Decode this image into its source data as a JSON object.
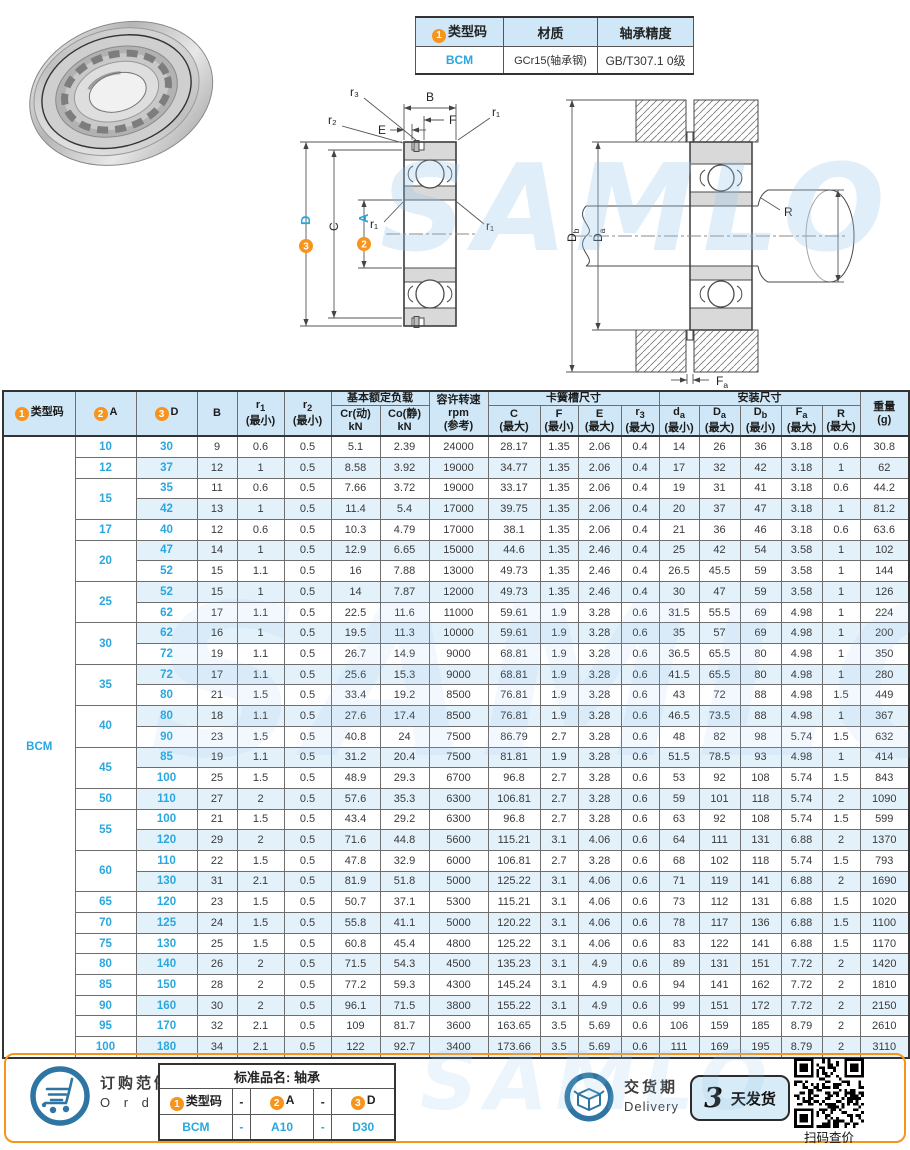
{
  "top_table": {
    "headers": {
      "type": {
        "badge": "1",
        "label": "类型码"
      },
      "material": "材质",
      "precision": "轴承精度"
    },
    "row": {
      "type_code": "BCM",
      "material": "GCr15(轴承钢)",
      "precision": "GB/T307.1 0级"
    }
  },
  "diagram": {
    "front": {
      "b": "B",
      "f": "F",
      "e": "E",
      "r3": "r₃",
      "r2": "r₂",
      "r1_tr": "r₁",
      "r1_ml": "r₁",
      "r1_mr": "r₁",
      "c": "C",
      "a": {
        "badge": "2",
        "letter": "A"
      },
      "d": {
        "badge": "3",
        "letter": "D"
      }
    },
    "mount": {
      "db": {
        "m": "D",
        "s": "b"
      },
      "da_housing": {
        "m": "D",
        "s": "a"
      },
      "da_shaft": {
        "m": "d",
        "s": "a"
      },
      "r": "R",
      "fa": {
        "m": "F",
        "s": "a"
      }
    }
  },
  "main_table": {
    "type_code": "BCM",
    "headers": {
      "type": {
        "badge": "1",
        "label": "类型码"
      },
      "a": {
        "badge": "2",
        "label": "A"
      },
      "d": {
        "badge": "3",
        "label": "D"
      },
      "b": "B",
      "r1": {
        "m": "r",
        "s": "1",
        "note": "(最小)"
      },
      "r2": {
        "m": "r",
        "s": "2",
        "note": "(最小)"
      },
      "load_group": "基本额定负载",
      "cr": {
        "l1": "Cr(动)",
        "l2": "kN"
      },
      "co": {
        "l1": "Co(静)",
        "l2": "kN"
      },
      "rpm": {
        "l1": "容许转速",
        "l2": "rpm",
        "l3": "(参考)"
      },
      "snap_group": "卡簧槽尺寸",
      "c": {
        "m": "C",
        "s": "",
        "note": "(最大)"
      },
      "f": {
        "m": "F",
        "s": "",
        "note": "(最小)"
      },
      "e": {
        "m": "E",
        "s": "",
        "note": "(最大)"
      },
      "r3": {
        "m": "r",
        "s": "3",
        "note": "(最大)"
      },
      "mount_group": "安装尺寸",
      "da": {
        "m": "d",
        "s": "a",
        "note": "(最小)"
      },
      "Da": {
        "m": "D",
        "s": "a",
        "note": "(最大)"
      },
      "Db": {
        "m": "D",
        "s": "b",
        "note": "(最小)"
      },
      "Fa": {
        "m": "F",
        "s": "a",
        "note": "(最大)"
      },
      "R": {
        "m": "R",
        "s": "",
        "note": "(最大)"
      },
      "weight": {
        "l1": "重量",
        "l2": "(g)"
      }
    },
    "groups": [
      {
        "a": "10",
        "rows": [
          {
            "d": "30",
            "v": [
              "9",
              "0.6",
              "0.5",
              "5.1",
              "2.39",
              "24000",
              "28.17",
              "1.35",
              "2.06",
              "0.4",
              "14",
              "26",
              "36",
              "3.18",
              "0.6",
              "30.8"
            ]
          }
        ]
      },
      {
        "a": "12",
        "rows": [
          {
            "d": "37",
            "v": [
              "12",
              "1",
              "0.5",
              "8.58",
              "3.92",
              "19000",
              "34.77",
              "1.35",
              "2.06",
              "0.4",
              "17",
              "32",
              "42",
              "3.18",
              "1",
              "62"
            ]
          }
        ]
      },
      {
        "a": "15",
        "rows": [
          {
            "d": "35",
            "v": [
              "11",
              "0.6",
              "0.5",
              "7.66",
              "3.72",
              "19000",
              "33.17",
              "1.35",
              "2.06",
              "0.4",
              "19",
              "31",
              "41",
              "3.18",
              "0.6",
              "44.2"
            ]
          },
          {
            "d": "42",
            "v": [
              "13",
              "1",
              "0.5",
              "11.4",
              "5.4",
              "17000",
              "39.75",
              "1.35",
              "2.06",
              "0.4",
              "20",
              "37",
              "47",
              "3.18",
              "1",
              "81.2"
            ]
          }
        ]
      },
      {
        "a": "17",
        "rows": [
          {
            "d": "40",
            "v": [
              "12",
              "0.6",
              "0.5",
              "10.3",
              "4.79",
              "17000",
              "38.1",
              "1.35",
              "2.06",
              "0.4",
              "21",
              "36",
              "46",
              "3.18",
              "0.6",
              "63.6"
            ]
          }
        ]
      },
      {
        "a": "20",
        "rows": [
          {
            "d": "47",
            "v": [
              "14",
              "1",
              "0.5",
              "12.9",
              "6.65",
              "15000",
              "44.6",
              "1.35",
              "2.46",
              "0.4",
              "25",
              "42",
              "54",
              "3.58",
              "1",
              "102"
            ]
          },
          {
            "d": "52",
            "v": [
              "15",
              "1.1",
              "0.5",
              "16",
              "7.88",
              "13000",
              "49.73",
              "1.35",
              "2.46",
              "0.4",
              "26.5",
              "45.5",
              "59",
              "3.58",
              "1",
              "144"
            ]
          }
        ]
      },
      {
        "a": "25",
        "rows": [
          {
            "d": "52",
            "v": [
              "15",
              "1",
              "0.5",
              "14",
              "7.87",
              "12000",
              "49.73",
              "1.35",
              "2.46",
              "0.4",
              "30",
              "47",
              "59",
              "3.58",
              "1",
              "126"
            ]
          },
          {
            "d": "62",
            "v": [
              "17",
              "1.1",
              "0.5",
              "22.5",
              "11.6",
              "11000",
              "59.61",
              "1.9",
              "3.28",
              "0.6",
              "31.5",
              "55.5",
              "69",
              "4.98",
              "1",
              "224"
            ]
          }
        ]
      },
      {
        "a": "30",
        "rows": [
          {
            "d": "62",
            "v": [
              "16",
              "1",
              "0.5",
              "19.5",
              "11.3",
              "10000",
              "59.61",
              "1.9",
              "3.28",
              "0.6",
              "35",
              "57",
              "69",
              "4.98",
              "1",
              "200"
            ]
          },
          {
            "d": "72",
            "v": [
              "19",
              "1.1",
              "0.5",
              "26.7",
              "14.9",
              "9000",
              "68.81",
              "1.9",
              "3.28",
              "0.6",
              "36.5",
              "65.5",
              "80",
              "4.98",
              "1",
              "350"
            ]
          }
        ]
      },
      {
        "a": "35",
        "rows": [
          {
            "d": "72",
            "v": [
              "17",
              "1.1",
              "0.5",
              "25.6",
              "15.3",
              "9000",
              "68.81",
              "1.9",
              "3.28",
              "0.6",
              "41.5",
              "65.5",
              "80",
              "4.98",
              "1",
              "280"
            ]
          },
          {
            "d": "80",
            "v": [
              "21",
              "1.5",
              "0.5",
              "33.4",
              "19.2",
              "8500",
              "76.81",
              "1.9",
              "3.28",
              "0.6",
              "43",
              "72",
              "88",
              "4.98",
              "1.5",
              "449"
            ]
          }
        ]
      },
      {
        "a": "40",
        "rows": [
          {
            "d": "80",
            "v": [
              "18",
              "1.1",
              "0.5",
              "27.6",
              "17.4",
              "8500",
              "76.81",
              "1.9",
              "3.28",
              "0.6",
              "46.5",
              "73.5",
              "88",
              "4.98",
              "1",
              "367"
            ]
          },
          {
            "d": "90",
            "v": [
              "23",
              "1.5",
              "0.5",
              "40.8",
              "24",
              "7500",
              "86.79",
              "2.7",
              "3.28",
              "0.6",
              "48",
              "82",
              "98",
              "5.74",
              "1.5",
              "632"
            ]
          }
        ]
      },
      {
        "a": "45",
        "rows": [
          {
            "d": "85",
            "v": [
              "19",
              "1.1",
              "0.5",
              "31.2",
              "20.4",
              "7500",
              "81.81",
              "1.9",
              "3.28",
              "0.6",
              "51.5",
              "78.5",
              "93",
              "4.98",
              "1",
              "414"
            ]
          },
          {
            "d": "100",
            "v": [
              "25",
              "1.5",
              "0.5",
              "48.9",
              "29.3",
              "6700",
              "96.8",
              "2.7",
              "3.28",
              "0.6",
              "53",
              "92",
              "108",
              "5.74",
              "1.5",
              "843"
            ]
          }
        ]
      },
      {
        "a": "50",
        "rows": [
          {
            "d": "110",
            "v": [
              "27",
              "2",
              "0.5",
              "57.6",
              "35.3",
              "6300",
              "106.81",
              "2.7",
              "3.28",
              "0.6",
              "59",
              "101",
              "118",
              "5.74",
              "2",
              "1090"
            ]
          }
        ]
      },
      {
        "a": "55",
        "rows": [
          {
            "d": "100",
            "v": [
              "21",
              "1.5",
              "0.5",
              "43.4",
              "29.2",
              "6300",
              "96.8",
              "2.7",
              "3.28",
              "0.6",
              "63",
              "92",
              "108",
              "5.74",
              "1.5",
              "599"
            ]
          },
          {
            "d": "120",
            "v": [
              "29",
              "2",
              "0.5",
              "71.6",
              "44.8",
              "5600",
              "115.21",
              "3.1",
              "4.06",
              "0.6",
              "64",
              "111",
              "131",
              "6.88",
              "2",
              "1370"
            ]
          }
        ]
      },
      {
        "a": "60",
        "rows": [
          {
            "d": "110",
            "v": [
              "22",
              "1.5",
              "0.5",
              "47.8",
              "32.9",
              "6000",
              "106.81",
              "2.7",
              "3.28",
              "0.6",
              "68",
              "102",
              "118",
              "5.74",
              "1.5",
              "793"
            ]
          },
          {
            "d": "130",
            "v": [
              "31",
              "2.1",
              "0.5",
              "81.9",
              "51.8",
              "5000",
              "125.22",
              "3.1",
              "4.06",
              "0.6",
              "71",
              "119",
              "141",
              "6.88",
              "2",
              "1690"
            ]
          }
        ]
      },
      {
        "a": "65",
        "rows": [
          {
            "d": "120",
            "v": [
              "23",
              "1.5",
              "0.5",
              "50.7",
              "37.1",
              "5300",
              "115.21",
              "3.1",
              "4.06",
              "0.6",
              "73",
              "112",
              "131",
              "6.88",
              "1.5",
              "1020"
            ]
          }
        ]
      },
      {
        "a": "70",
        "rows": [
          {
            "d": "125",
            "v": [
              "24",
              "1.5",
              "0.5",
              "55.8",
              "41.1",
              "5000",
              "120.22",
              "3.1",
              "4.06",
              "0.6",
              "78",
              "117",
              "136",
              "6.88",
              "1.5",
              "1100"
            ]
          }
        ]
      },
      {
        "a": "75",
        "rows": [
          {
            "d": "130",
            "v": [
              "25",
              "1.5",
              "0.5",
              "60.8",
              "45.4",
              "4800",
              "125.22",
              "3.1",
              "4.06",
              "0.6",
              "83",
              "122",
              "141",
              "6.88",
              "1.5",
              "1170"
            ]
          }
        ]
      },
      {
        "a": "80",
        "rows": [
          {
            "d": "140",
            "v": [
              "26",
              "2",
              "0.5",
              "71.5",
              "54.3",
              "4500",
              "135.23",
              "3.1",
              "4.9",
              "0.6",
              "89",
              "131",
              "151",
              "7.72",
              "2",
              "1420"
            ]
          }
        ]
      },
      {
        "a": "85",
        "rows": [
          {
            "d": "150",
            "v": [
              "28",
              "2",
              "0.5",
              "77.2",
              "59.3",
              "4300",
              "145.24",
              "3.1",
              "4.9",
              "0.6",
              "94",
              "141",
              "162",
              "7.72",
              "2",
              "1810"
            ]
          }
        ]
      },
      {
        "a": "90",
        "rows": [
          {
            "d": "160",
            "v": [
              "30",
              "2",
              "0.5",
              "96.1",
              "71.5",
              "3800",
              "155.22",
              "3.1",
              "4.9",
              "0.6",
              "99",
              "151",
              "172",
              "7.72",
              "2",
              "2150"
            ]
          }
        ]
      },
      {
        "a": "95",
        "rows": [
          {
            "d": "170",
            "v": [
              "32",
              "2.1",
              "0.5",
              "109",
              "81.7",
              "3600",
              "163.65",
              "3.5",
              "5.69",
              "0.6",
              "106",
              "159",
              "185",
              "8.79",
              "2",
              "2610"
            ]
          }
        ]
      },
      {
        "a": "100",
        "rows": [
          {
            "d": "180",
            "v": [
              "34",
              "2.1",
              "0.5",
              "122",
              "92.7",
              "3400",
              "173.66",
              "3.5",
              "5.69",
              "0.6",
              "111",
              "169",
              "195",
              "8.79",
              "2",
              "3110"
            ]
          }
        ]
      }
    ]
  },
  "footer": {
    "order": {
      "title_cn": "订购范例",
      "title_en": "O r d e r",
      "table_title": "标准品名: 轴承",
      "code_header": {
        "badge": "1",
        "label": "类型码"
      },
      "a_header": {
        "badge": "2",
        "label": "A"
      },
      "d_header": {
        "badge": "3",
        "label": "D"
      },
      "dash": "-",
      "example": {
        "code": "BCM",
        "a": "A10",
        "d": "D30"
      }
    },
    "delivery": {
      "title_cn": "交货期",
      "title_en": "Delivery",
      "days": "3",
      "label": "天发货"
    },
    "qr": {
      "caption": "扫码查价"
    }
  },
  "watermark": {
    "text": "SAMLO"
  },
  "colors": {
    "accent_orange": "#f7941d",
    "accent_blue": "#2aa7de",
    "header_bg": "#cfe7f6",
    "row_alt_bg": "#e3f1fb",
    "icon_blue": "#2e75a3"
  }
}
